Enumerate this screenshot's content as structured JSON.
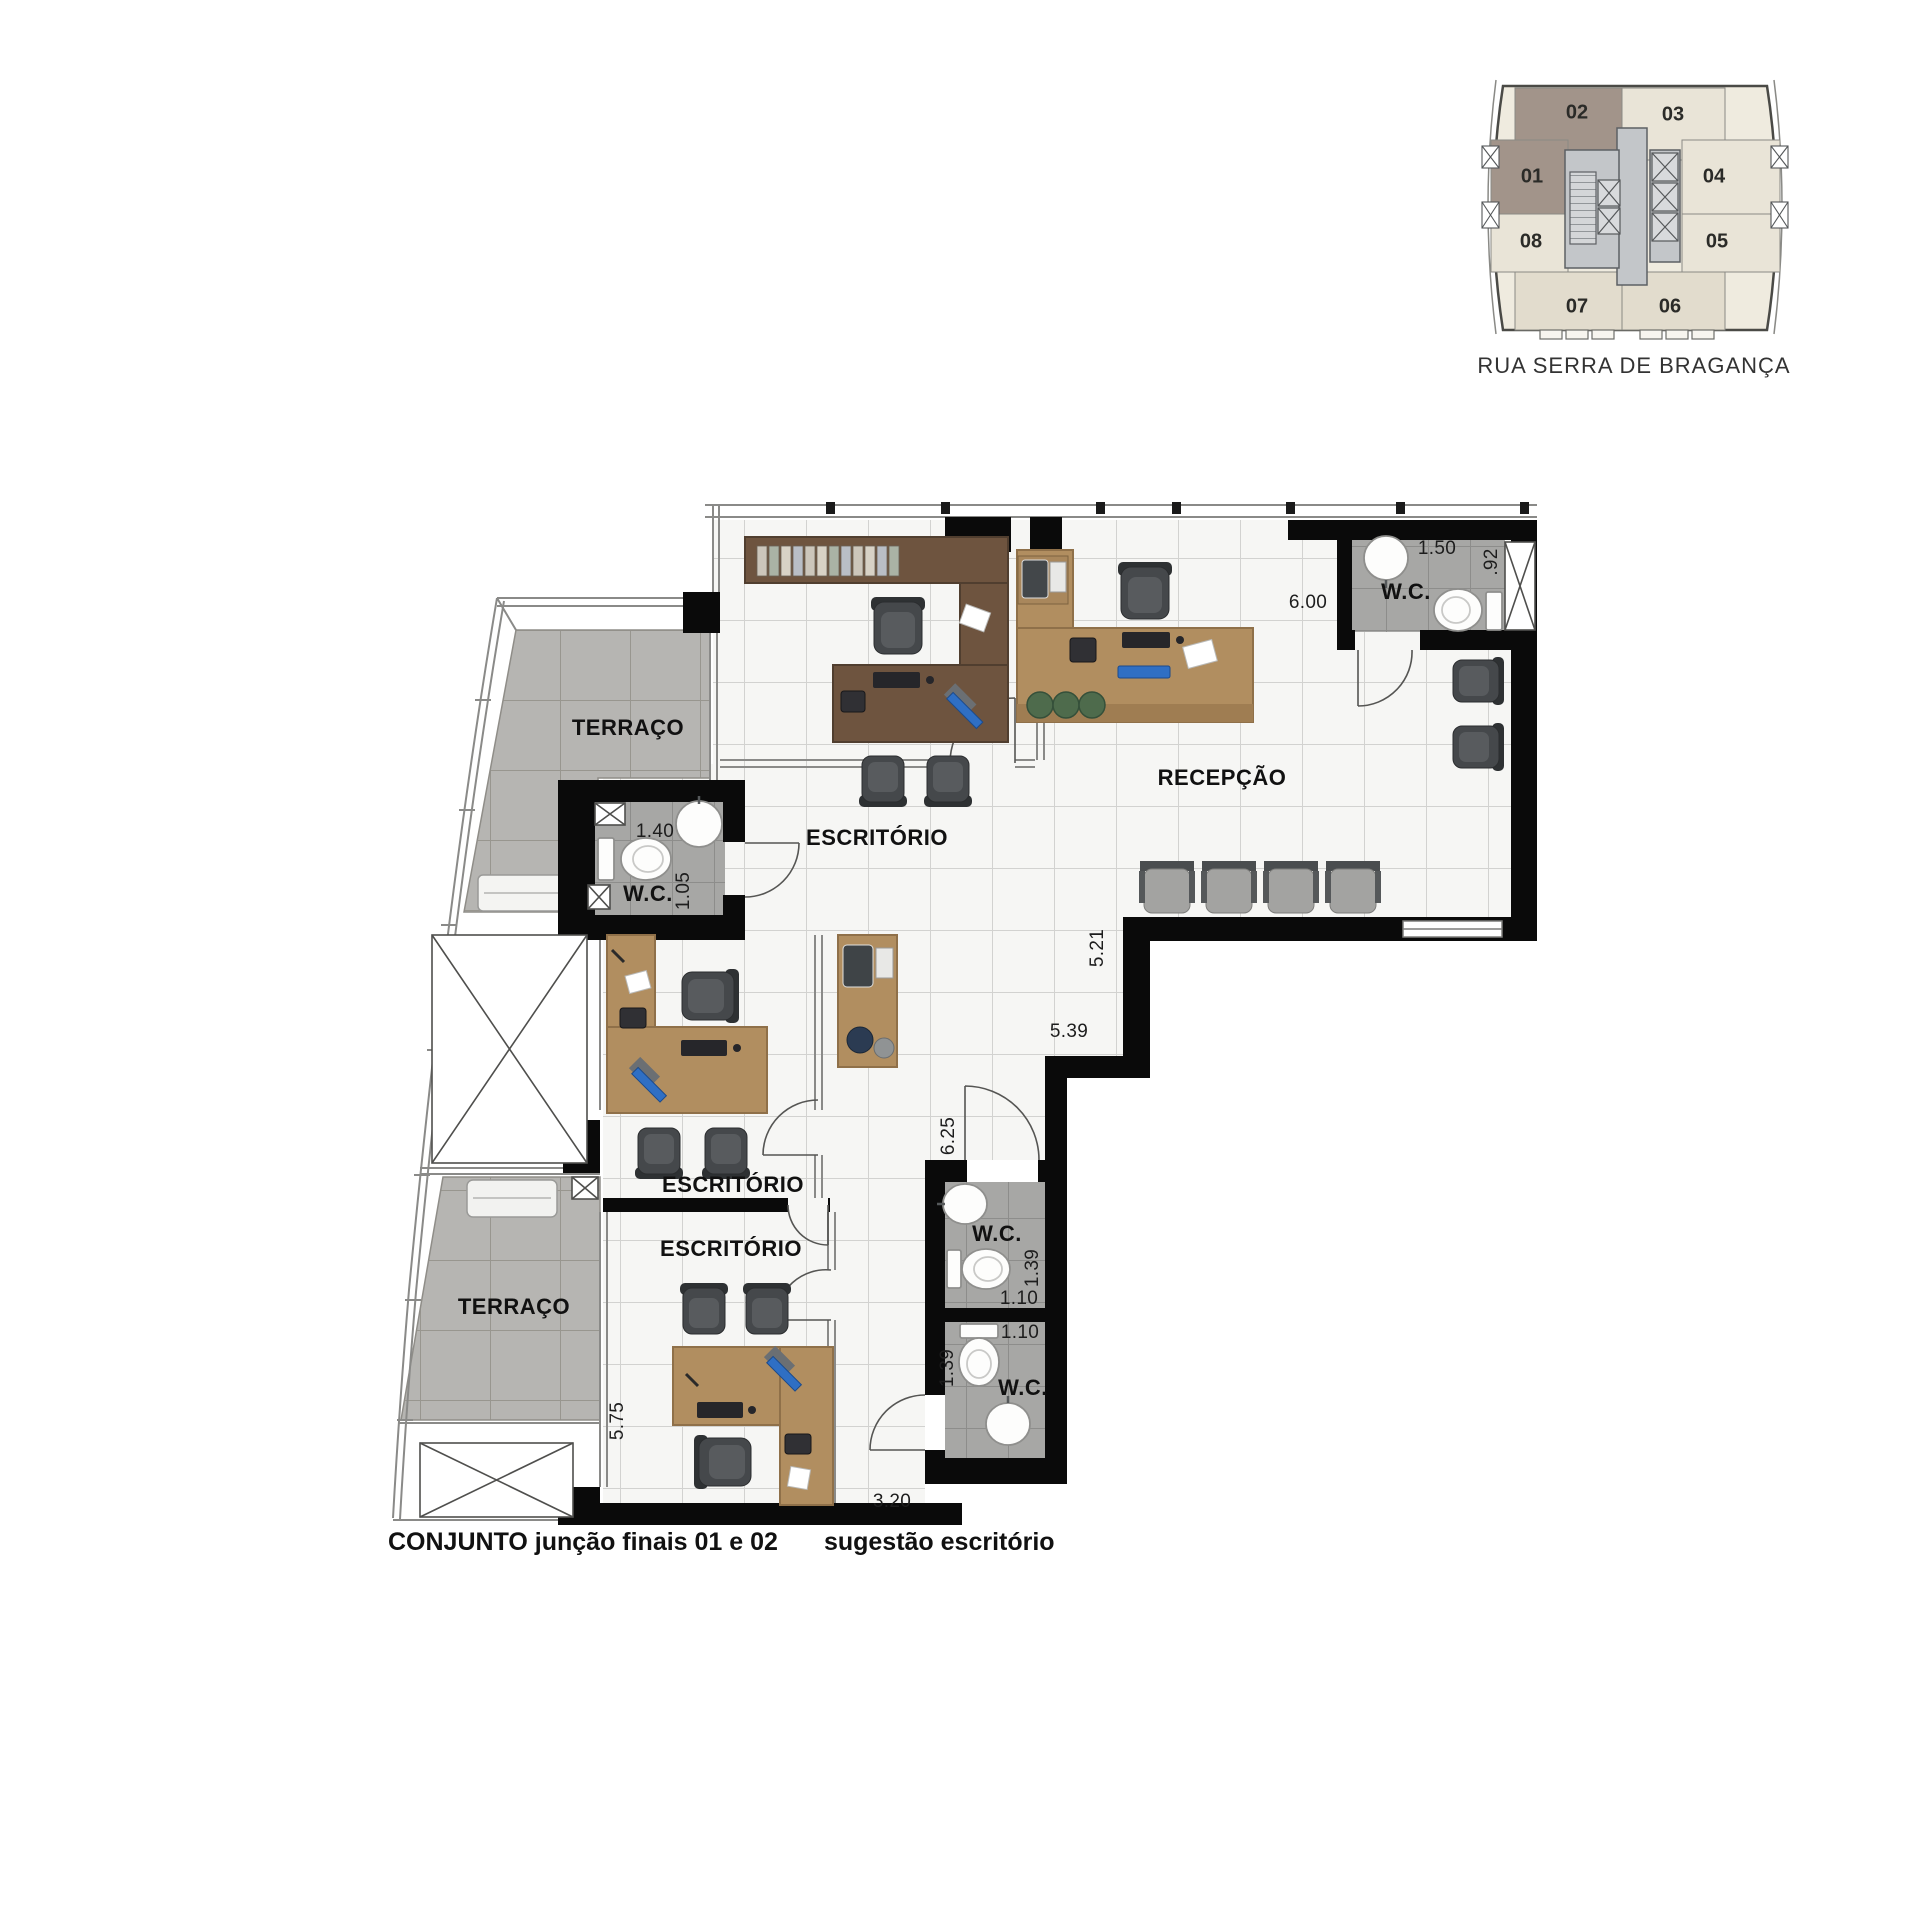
{
  "key_plan": {
    "street": "RUA SERRA DE BRAGANÇA",
    "units": {
      "u01": "01",
      "u02": "02",
      "u03": "03",
      "u04": "04",
      "u05": "05",
      "u06": "06",
      "u07": "07",
      "u08": "08"
    },
    "highlighted_units": "01 e 02",
    "colors": {
      "highlight": "#a2948a",
      "unit": "#e9e4d7",
      "core": "#c3c6c9"
    }
  },
  "plan": {
    "rooms": {
      "terrace_upper": "TERRAÇO",
      "terrace_lower": "TERRAÇO",
      "office_1": "ESCRITÓRIO",
      "office_2": "ESCRITÓRIO",
      "office_3": "ESCRITÓRIO",
      "reception": "RECEPÇÃO",
      "wc_1": "W.C.",
      "wc_2": "W.C.",
      "wc_3": "W.C.",
      "wc_4": "W.C."
    },
    "dimensions": {
      "wc2_width": "1.50",
      "wc2_depth": ".92",
      "reception_width": "6.00",
      "wc1_width": "1.40",
      "wc1_depth": "1.05",
      "reception_depth": "5.21",
      "hall_width": "5.39",
      "hall_depth": "6.25",
      "wc3_depth": "1.39",
      "wc3_width": "1.10",
      "wc4_width": "1.10",
      "wc4_depth": "1.39",
      "office3_depth": "5.75",
      "office3_width": "3.20"
    },
    "caption_title": "CONJUNTO junção finais 01 e 02",
    "caption_subtitle": "sugestão escritório",
    "colors": {
      "wall": "#0a0a0a",
      "wood_dark": "#6e543f",
      "wood_light": "#b18e60",
      "terrace_tile": "#b6b5b2",
      "wc_tile": "#a7a7a5",
      "monitor_blue": "#2f6fc4"
    }
  }
}
